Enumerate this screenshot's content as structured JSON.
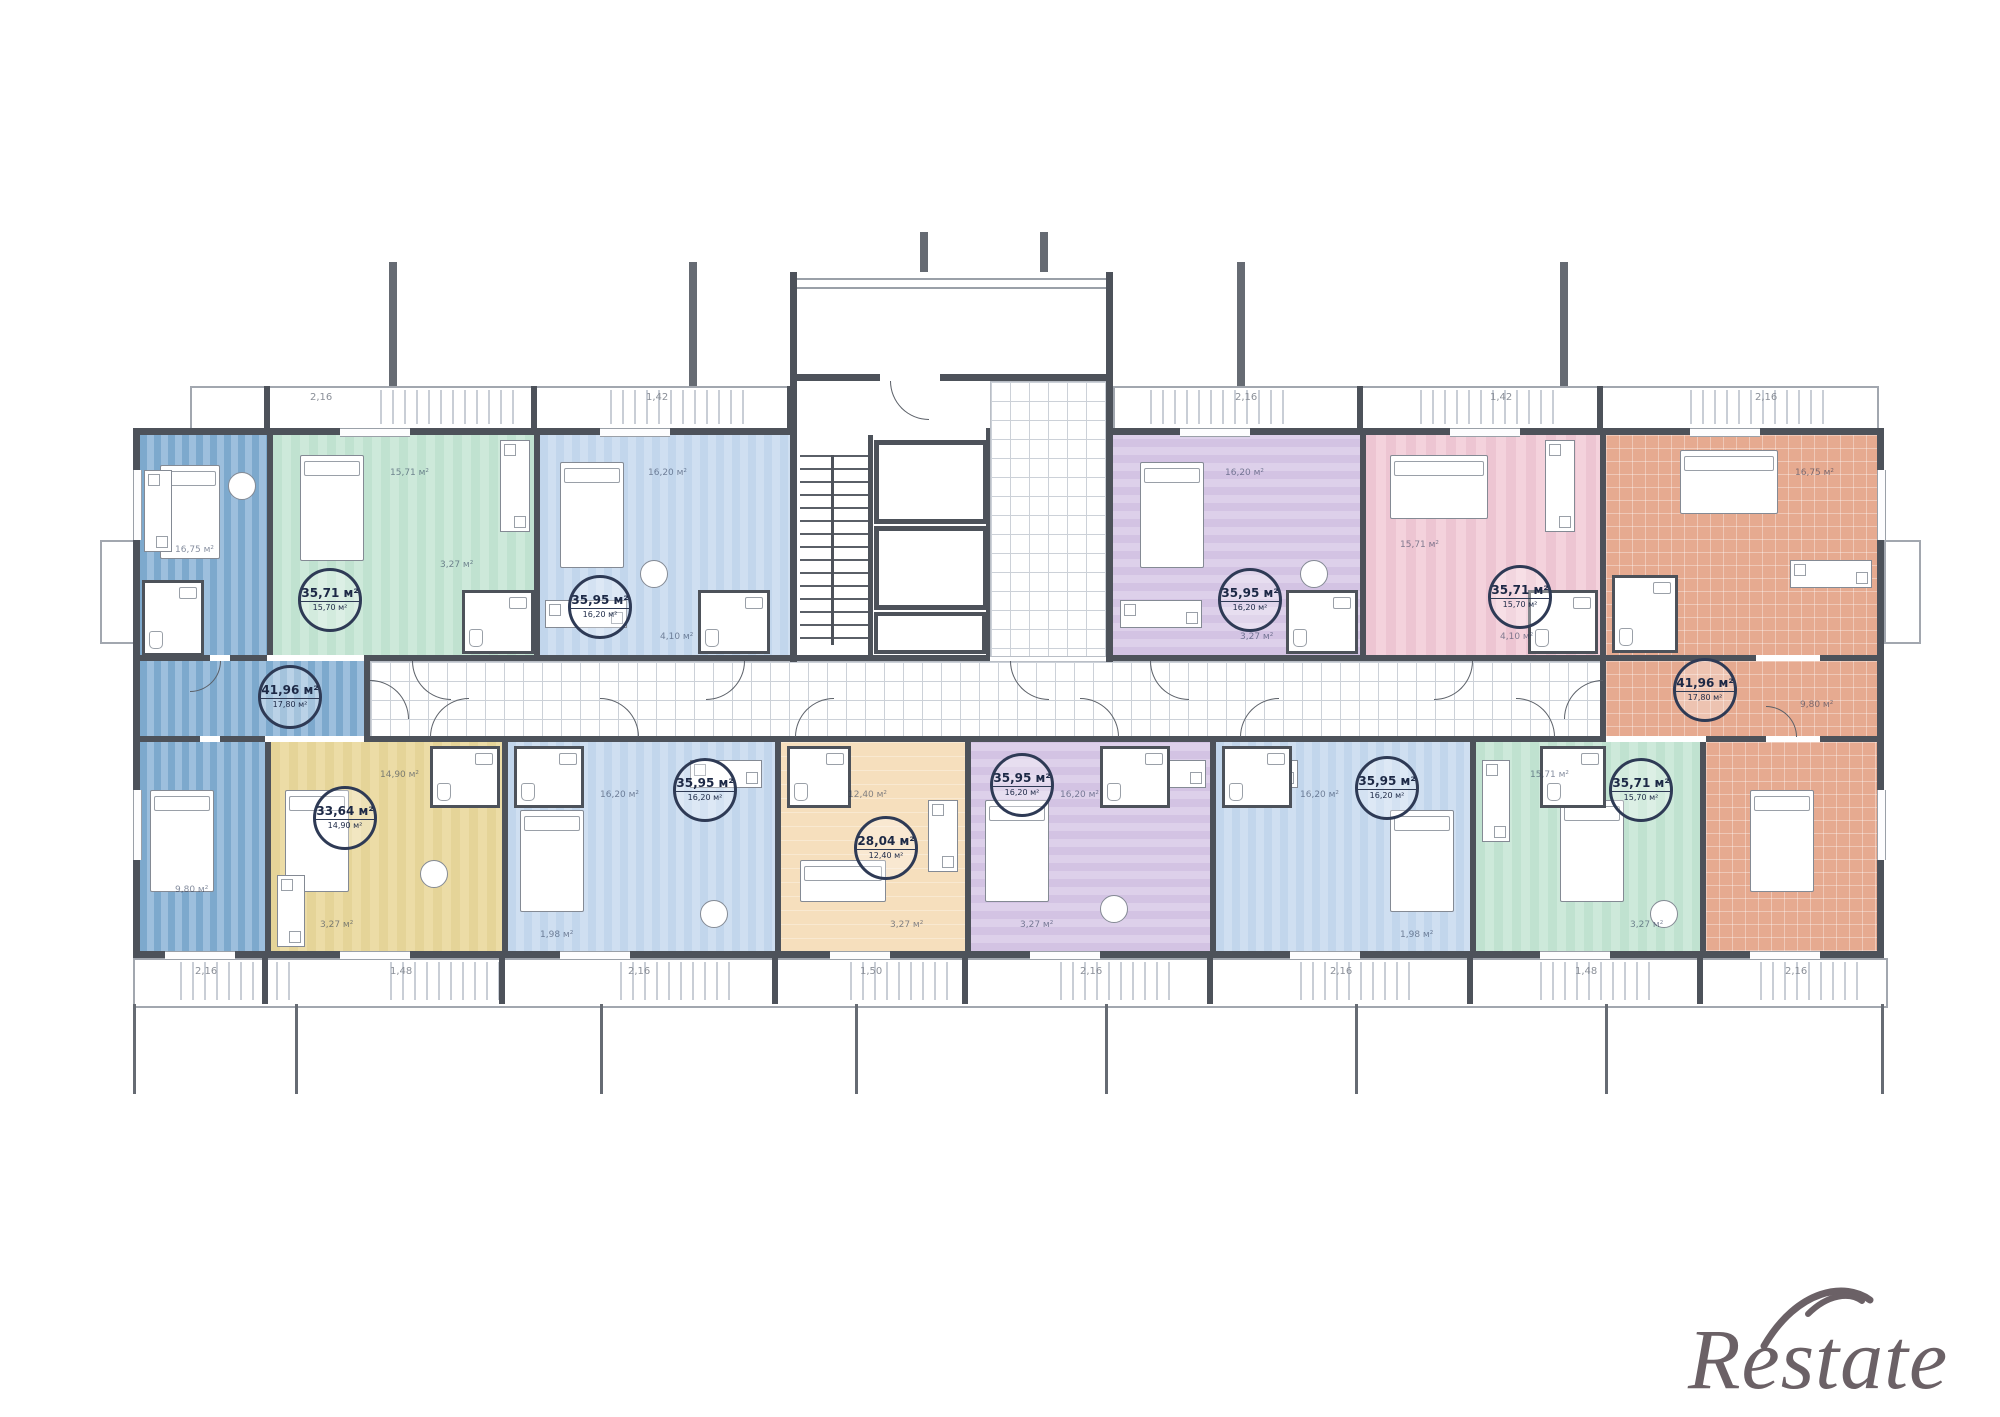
{
  "colors": {
    "wall": "#4d525a",
    "line": "#9aa0a8",
    "tile_line": "#ccd1d8",
    "text_dark": "#223150",
    "blue_a": "#9dbfdd",
    "blue_b": "#7da9cd",
    "teal_a": "#cde9da",
    "teal_b": "#c0e2d0",
    "lblue_a": "#cfdff1",
    "lblue_b": "#c2d6ec",
    "lilac_a": "#ddd0ea",
    "lilac_b": "#d3c3e3",
    "pink_a": "#f4d2dc",
    "pink_b": "#edc5d2",
    "salmon_a": "#edb89f",
    "salmon_b": "#e6aa90",
    "yellow_a": "#ecdca6",
    "yellow_b": "#e5d498",
    "peach_a": "#f6dfbd",
    "watermark": "#6b6166"
  },
  "apartments": [
    {
      "name": "corner apartment left (blue)",
      "color": "blue",
      "area": "41,96 м²",
      "living": "17,80 м²",
      "room_labels": [
        "16,75 м²",
        "9,80 м²"
      ]
    },
    {
      "name": "apartment top (mint)",
      "color": "teal",
      "area": "35,71 м²",
      "living": "15,70 м²",
      "room_labels": [
        "15,71 м²",
        "3,27 м²"
      ]
    },
    {
      "name": "apartment top (light blue)",
      "color": "lblue",
      "area": "35,95 м²",
      "living": "16,20 м²",
      "room_labels": [
        "16,20 м²",
        "4,10 м²"
      ]
    },
    {
      "name": "apartment top (lilac)",
      "color": "lilac",
      "area": "35,95 м²",
      "living": "16,20 м²",
      "room_labels": [
        "16,20 м²",
        "3,27 м²"
      ]
    },
    {
      "name": "apartment top (pink)",
      "color": "pink",
      "area": "35,71 м²",
      "living": "15,70 м²",
      "room_labels": [
        "15,71 м²",
        "4,10 м²"
      ]
    },
    {
      "name": "corner apartment right (salmon)",
      "color": "salmon",
      "area": "41,96 м²",
      "living": "17,80 м²",
      "room_labels": [
        "16,75 м²",
        "9,80 м²"
      ]
    },
    {
      "name": "apartment bottom (yellow)",
      "color": "yellow",
      "area": "33,64 м²",
      "living": "14,90 м²",
      "room_labels": [
        "14,90 м²",
        "3,27 м²"
      ]
    },
    {
      "name": "apartment bottom 1 (light blue)",
      "color": "lblue",
      "area": "35,95 м²",
      "living": "16,20 м²",
      "room_labels": [
        "16,20 м²",
        "1,98 м²"
      ]
    },
    {
      "name": "studio apartment bottom (peach)",
      "color": "peach",
      "area": "28,04 м²",
      "living": "12,40 м²",
      "room_labels": [
        "12,40 м²",
        "3,27 м²"
      ]
    },
    {
      "name": "apartment bottom (lilac)",
      "color": "lilac",
      "area": "35,95 м²",
      "living": "16,20 м²",
      "room_labels": [
        "16,20 м²",
        "3,27 м²"
      ]
    },
    {
      "name": "apartment bottom 2 (light blue)",
      "color": "lblue",
      "area": "35,95 м²",
      "living": "16,20 м²",
      "room_labels": [
        "16,20 м²",
        "1,98 м²"
      ]
    },
    {
      "name": "apartment bottom (mint)",
      "color": "teal",
      "area": "35,71 м²",
      "living": "15,70 м²",
      "room_labels": [
        "15,71 м²",
        "3,27 м²"
      ]
    }
  ],
  "balconies": {
    "top_labels": [
      "2,16",
      "1,42",
      "2,16",
      "1,42",
      "2,16"
    ],
    "bottom_labels": [
      "2,16",
      "1,48",
      "2,16",
      "1,50",
      "2,16",
      "2,16",
      "1,48",
      "2,16"
    ]
  },
  "watermark": {
    "text": "Restate"
  }
}
